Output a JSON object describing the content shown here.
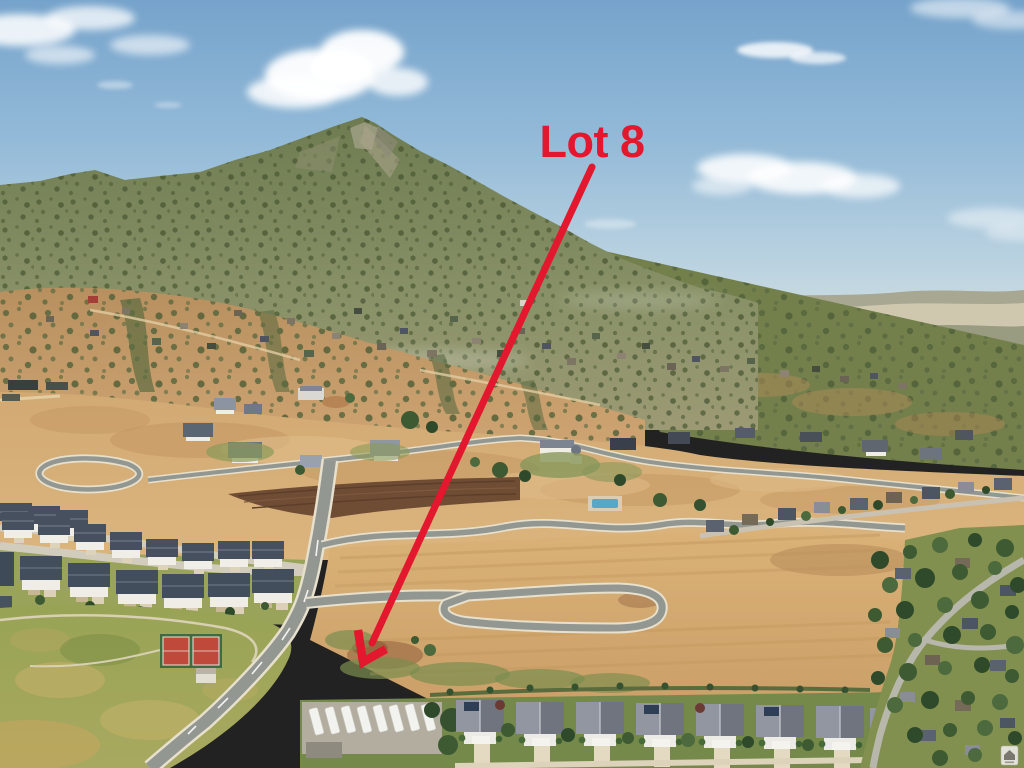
{
  "annotation": {
    "label": "Lot 8",
    "color": "#e3172d"
  },
  "icons": {
    "watermark": "mls-watermark-icon"
  }
}
